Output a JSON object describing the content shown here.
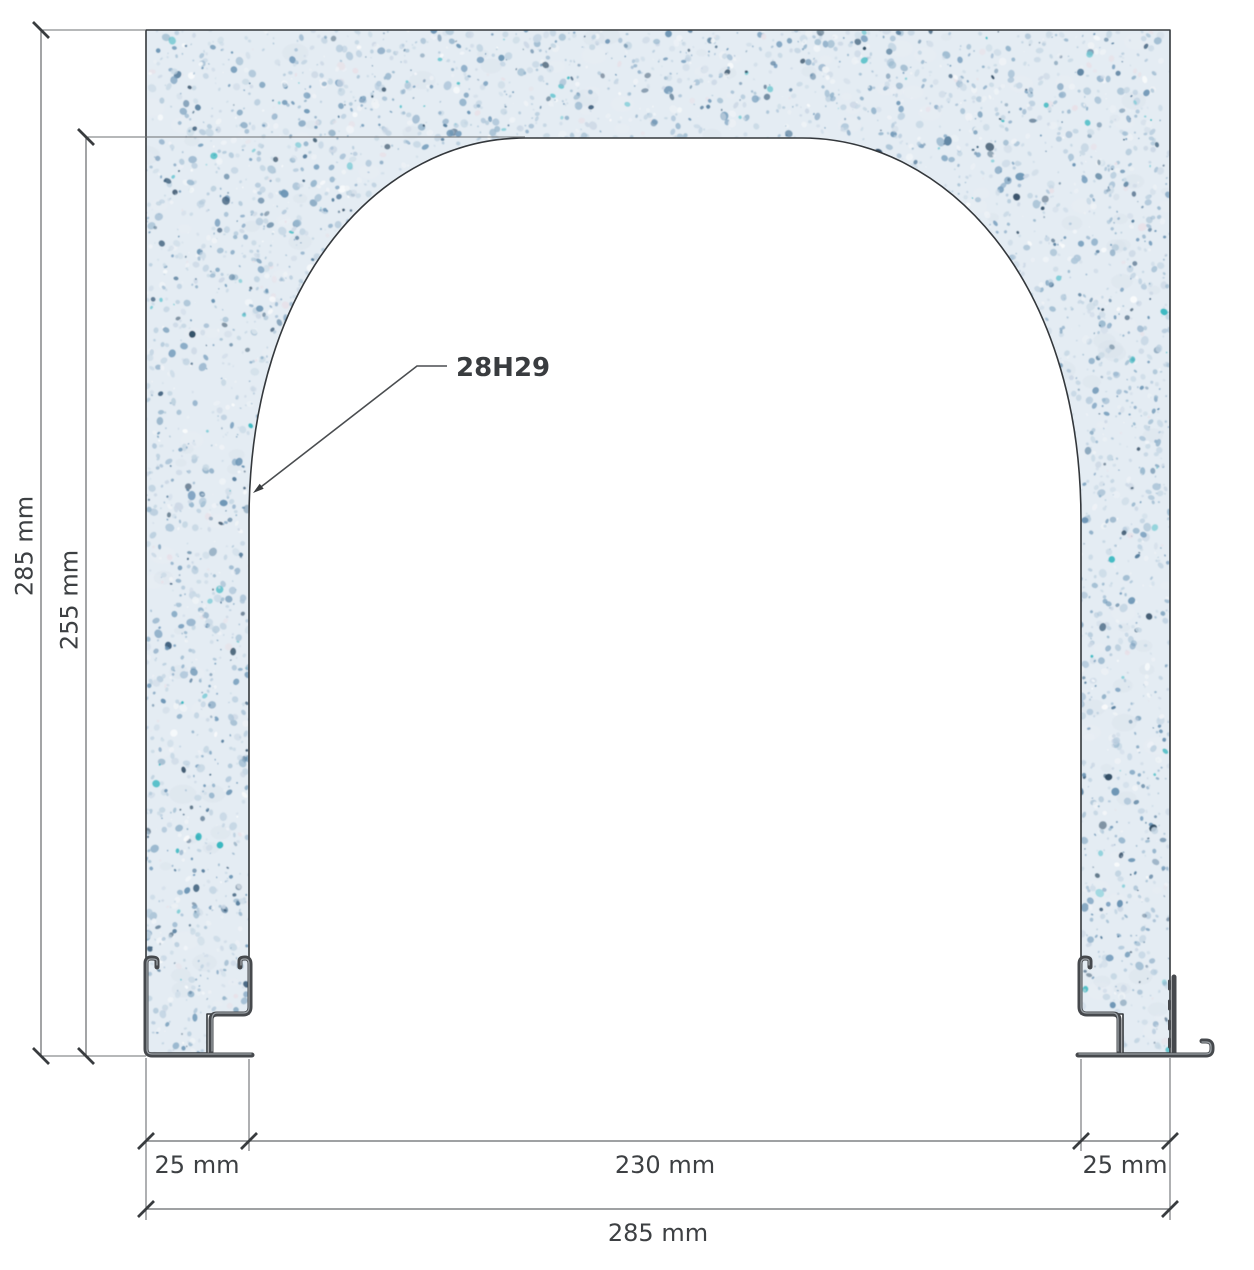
{
  "title": "Arched panel cross-section drawing",
  "part": {
    "code": "28H29"
  },
  "dimensions": {
    "overall_height": "285 mm",
    "opening_height": "255 mm",
    "left_thickness": "25 mm",
    "opening_width": "230 mm",
    "right_thickness": "25 mm",
    "overall_width": "285 mm"
  },
  "colors": {
    "panel_base": "#e4ecf3",
    "speckle_blue": "#7da2c0",
    "speckle_dark": "#2e4a62",
    "speckle_teal": "#38b7c0",
    "line": "#34383c",
    "dimension_line": "#66696c",
    "text": "#3d4043",
    "profile": "#46494d"
  }
}
